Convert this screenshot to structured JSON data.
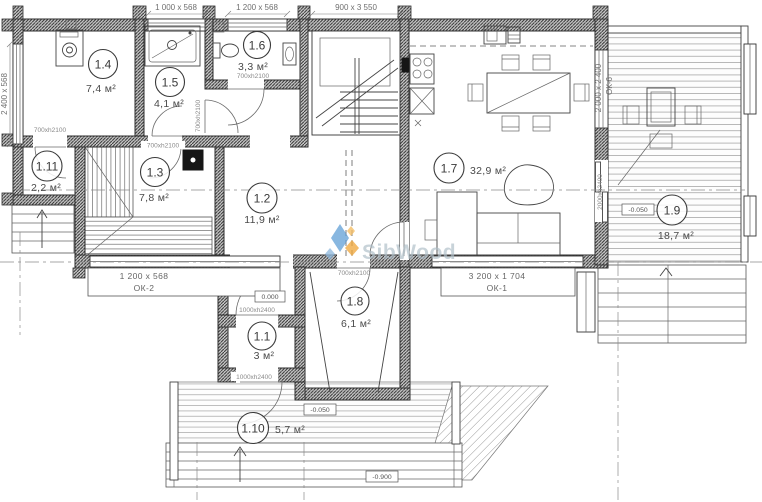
{
  "watermark": {
    "text": "SibWood"
  },
  "rooms": {
    "r1_1": {
      "num": "1.1",
      "area": "3 м²"
    },
    "r1_2": {
      "num": "1.2",
      "area": "11,9 м²"
    },
    "r1_3": {
      "num": "1.3",
      "area": "7,8 м²"
    },
    "r1_4": {
      "num": "1.4",
      "area": "7,4 м²"
    },
    "r1_5": {
      "num": "1.5",
      "area": "4,1 м²"
    },
    "r1_6": {
      "num": "1.6",
      "area": "3,3 м²"
    },
    "r1_7": {
      "num": "1.7",
      "area": "32,9 м²"
    },
    "r1_8": {
      "num": "1.8",
      "area": "6,1 м²"
    },
    "r1_9": {
      "num": "1.9",
      "area": "18,7 м²"
    },
    "r1_10": {
      "num": "1.10",
      "area": "5,7 м²"
    },
    "r1_11": {
      "num": "1.11",
      "area": "2,2 м²"
    }
  },
  "dims": {
    "top_window_1": "1 000 x 568",
    "top_window_2": "1 200 x 568",
    "stair_opening": "900 x 3 550",
    "left_window": "2 400 x 568",
    "ok6_size": "2 000 x 2 400",
    "ok6_name": "ОК-6",
    "terrace_door": "2000xh2400",
    "ok2_size": "1 200 x 568",
    "ok2_name": "ОК-2",
    "ok1_size": "3 200 x 1 704",
    "ok1_name": "ОК-1",
    "door_700": "700xh2100",
    "door_1000": "1000xh2400"
  },
  "levels": {
    "zero": "0.000",
    "minus_050": "-0.050",
    "minus_900": "-0.900"
  },
  "colors": {
    "wall_line": "#2e2e2e",
    "dim_text": "#6f6f6f",
    "logo_blue": "#5b9bd5",
    "logo_orange": "#f0a63a",
    "watermark_text": "#b0bfc9"
  }
}
